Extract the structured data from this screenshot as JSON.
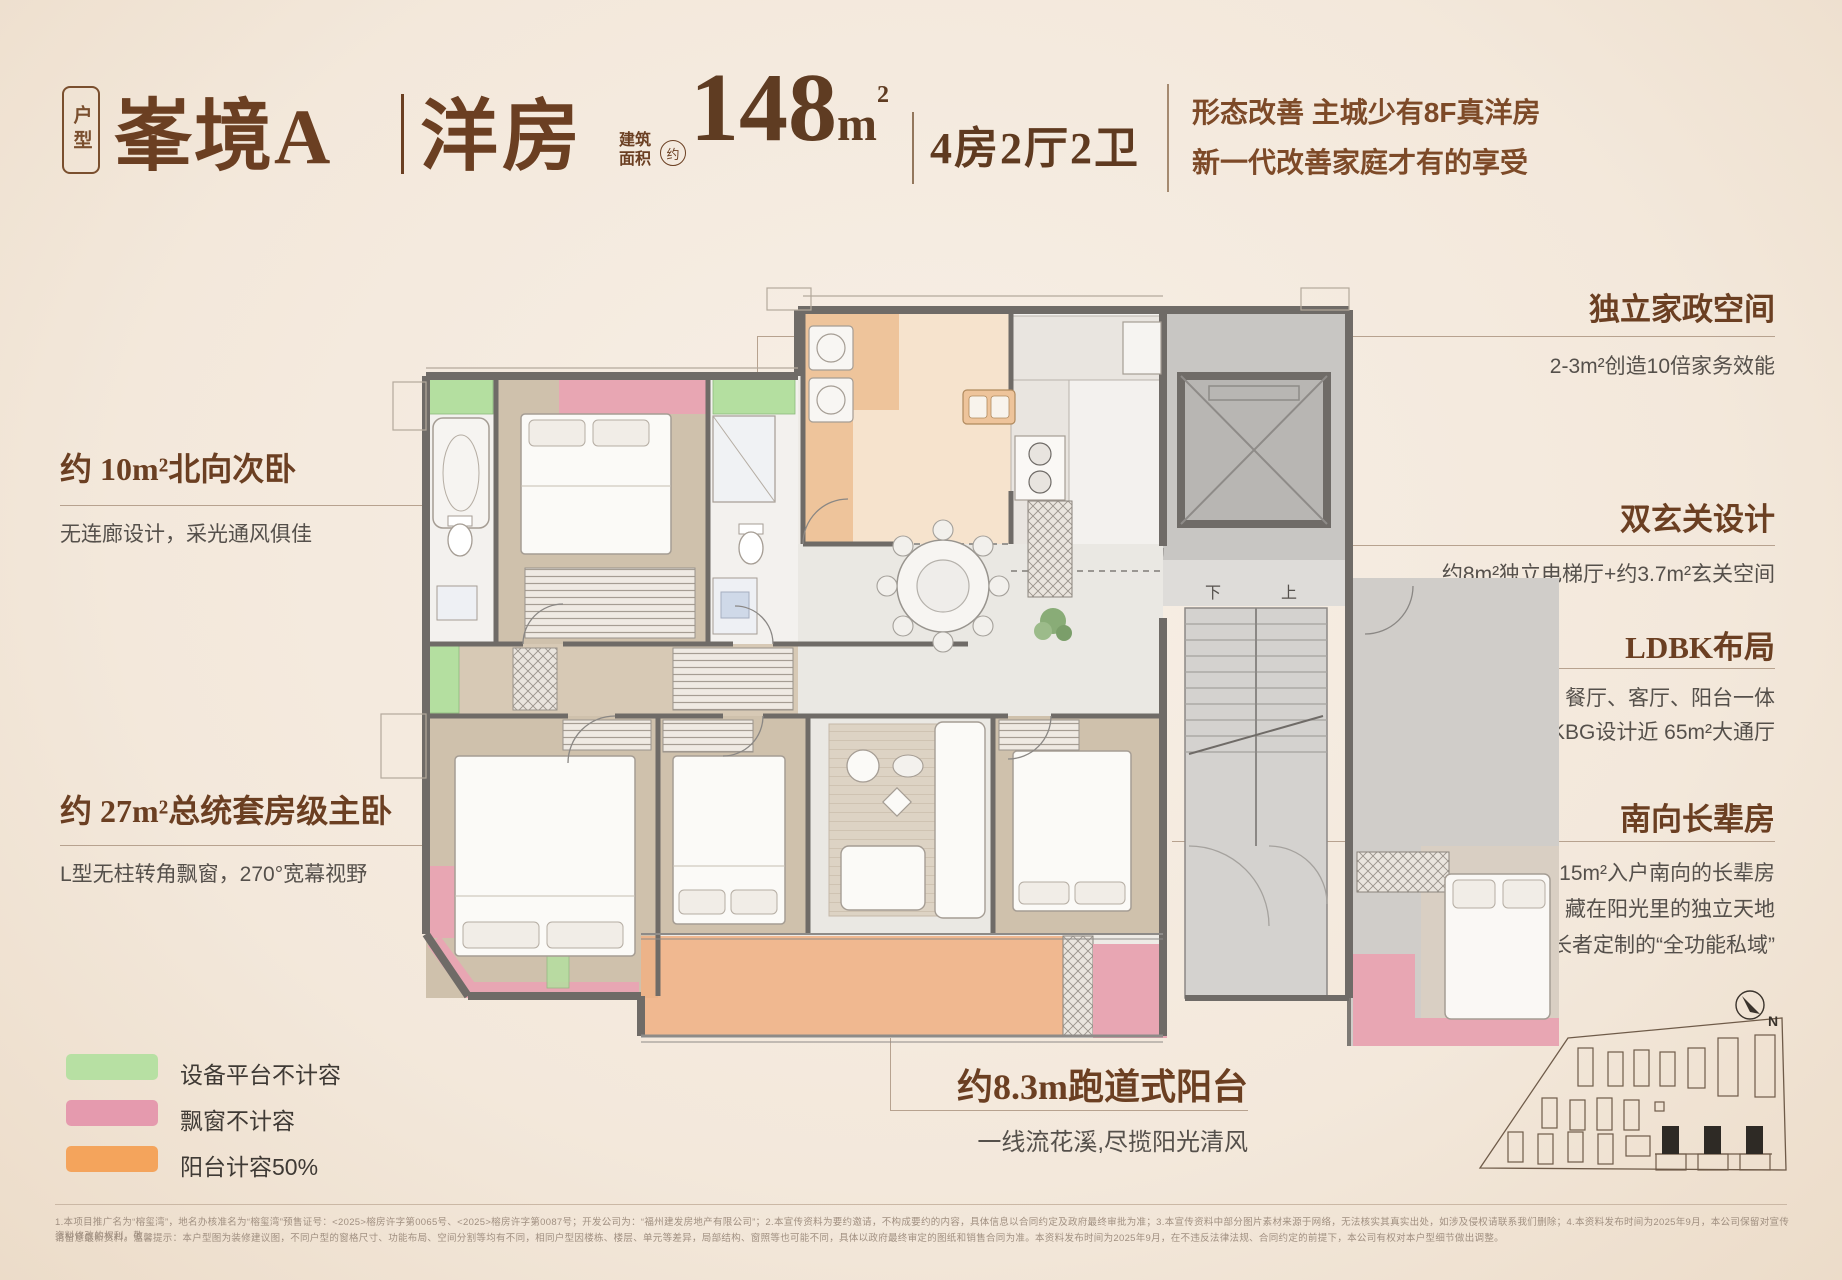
{
  "header": {
    "badge": "户型",
    "title_main": "峯境A",
    "title_sub": "洋房",
    "area_prefix_line1": "建筑",
    "area_prefix_line2": "面积",
    "area_about": "约",
    "area_value": "148",
    "area_unit": "m",
    "area_sup": "2",
    "layout": "4房2厅2卫",
    "slogan_line1": "形态改善 主城少有8F真洋房",
    "slogan_line2": "新一代改善家庭才有的享受"
  },
  "annotations": {
    "north_bedroom": {
      "title": "约 10m²北向次卧",
      "desc": "无连廊设计，采光通风俱佳"
    },
    "master_bedroom": {
      "title": "约 27m²总统套房级主卧",
      "desc": "L型无柱转角飘窗，270°宽幕视野"
    },
    "housework": {
      "title": "独立家政空间",
      "desc": "2-3m²创造10倍家务效能"
    },
    "foyer": {
      "title": "双玄关设计",
      "desc": "约8m²独立电梯厅+约3.7m²玄关空间"
    },
    "ldbk": {
      "title": "LDBK布局",
      "desc_line1": "厨房、餐厅、客厅、阳台一体",
      "desc_line2": "LDKBG设计近 65m²大通厅"
    },
    "elder_room": {
      "title": "南向长辈房",
      "desc_line1": "约15m²入户南向的长辈房",
      "desc_line2": "藏在阳光里的独立天地",
      "desc_line3": "是专为长者定制的“全功能私域”"
    },
    "balcony": {
      "title": "约8.3m跑道式阳台",
      "desc": "一线流花溪,尽揽阳光清风"
    }
  },
  "legend": {
    "items": [
      {
        "label": "设备平台不计容",
        "color": "#b7e0a3"
      },
      {
        "label": "飘窗不计容",
        "color": "#e59aae"
      },
      {
        "label": "阳台计容50%",
        "color": "#f4a45c"
      }
    ]
  },
  "floorplan": {
    "stair_down": "下",
    "stair_up": "上"
  },
  "sitemap": {
    "north_label": "N"
  },
  "disclaimer": {
    "line1": "1.本项目推广名为“榕玺湾”，地名办核准名为“榕玺湾”预售证号：<2025>榕房许字第0065号、<2025>榕房许字第0087号；开发公司为：“福州建发房地产有限公司”；2.本宣传资料为要约邀请，不构成要约的内容，具体信息以合同约定及政府最终审批为准；3.本宣传资料中部分图片素材来源于网络，无法核实其真实出处，如涉及侵权请联系我们删除；4.本资料发布时间为2025年9月，本公司保留对宣传资料修改的权利，敬",
    "line2": "请留意最新资料。温馨提示：本户型图为装修建议图，不同户型的窗格尺寸、功能布局、空间分割等均有不同，相同户型因楼栋、楼层、单元等差异，局部结构、窗照等也可能不同，具体以政府最终审定的图纸和销售合同为准。本资料发布时间为2025年9月，在不违反法律法规、合同约定的前提下，本公司有权对本户型细节做出调整。"
  }
}
